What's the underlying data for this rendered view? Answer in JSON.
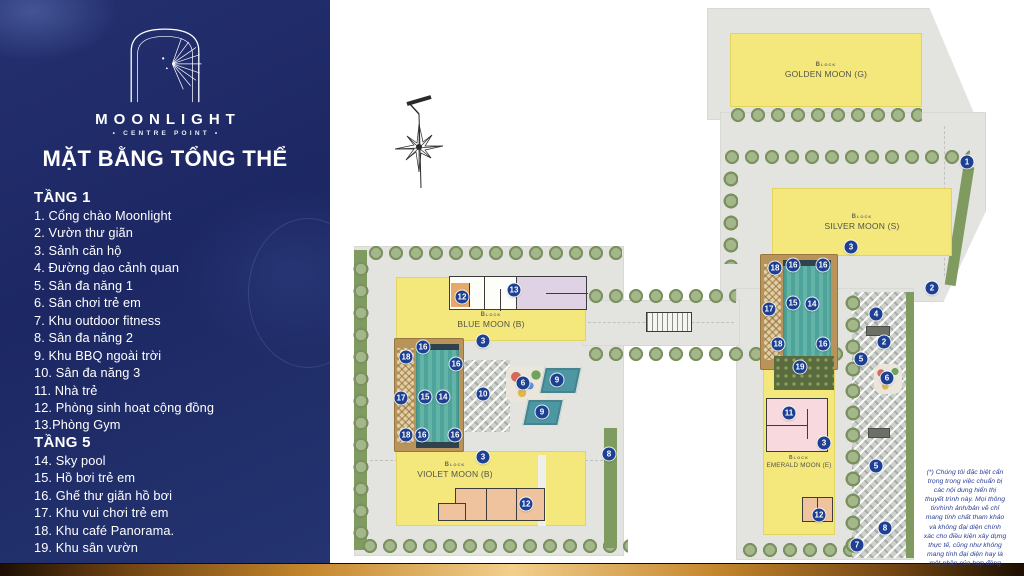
{
  "brand": {
    "name": "MOONLIGHT",
    "tagline": "• CENTRE POINT •"
  },
  "sidebar": {
    "title": "MẶT BẰNG TỔNG THỂ",
    "sections": [
      {
        "heading": "TẦNG 1",
        "items": [
          "1. Cổng chào Moonlight",
          "2. Vườn thư giãn",
          "3. Sảnh căn hộ",
          "4. Đường dạo cảnh quan",
          "5. Sân đa năng 1",
          "6. Sân chơi trẻ em",
          "7. Khu outdoor fitness",
          "8. Sân đa năng 2",
          "9. Khu BBQ ngoài trời",
          "10. Sân đa năng 3",
          "11. Nhà trẻ",
          "12. Phòng sinh hoạt cộng đồng",
          "13.Phòng Gym"
        ]
      },
      {
        "heading": "TẦNG 5",
        "items": [
          "14. Sky pool",
          "15. Hồ bơi trẻ em",
          "16. Ghế thư giãn hồ bơi",
          "17. Khu vui chơi trẻ em",
          "18. Khu café Panorama.",
          "19. Khu sân vườn"
        ]
      }
    ]
  },
  "map": {
    "blocks": [
      {
        "id": "golden",
        "block_label": "Block",
        "name": "GOLDEN MOON (G)"
      },
      {
        "id": "silver",
        "block_label": "Block",
        "name": "SILVER MOON (S)"
      },
      {
        "id": "blue",
        "block_label": "Block",
        "name": "BLUE MOON (B)"
      },
      {
        "id": "violet",
        "block_label": "Block",
        "name": "VIOLET MOON (B)"
      },
      {
        "id": "emerald",
        "block_label": "Block",
        "name": "EMERALD MOON (E)"
      }
    ],
    "markers": [
      {
        "n": "1",
        "x": 637,
        "y": 162
      },
      {
        "n": "3",
        "x": 521,
        "y": 247
      },
      {
        "n": "18",
        "x": 445,
        "y": 268
      },
      {
        "n": "16",
        "x": 463,
        "y": 265
      },
      {
        "n": "16",
        "x": 493,
        "y": 265
      },
      {
        "n": "17",
        "x": 439,
        "y": 309
      },
      {
        "n": "15",
        "x": 463,
        "y": 303
      },
      {
        "n": "14",
        "x": 482,
        "y": 304
      },
      {
        "n": "18",
        "x": 448,
        "y": 344
      },
      {
        "n": "16",
        "x": 493,
        "y": 344
      },
      {
        "n": "19",
        "x": 470,
        "y": 367
      },
      {
        "n": "2",
        "x": 602,
        "y": 288
      },
      {
        "n": "4",
        "x": 546,
        "y": 314
      },
      {
        "n": "2",
        "x": 554,
        "y": 342
      },
      {
        "n": "5",
        "x": 531,
        "y": 359
      },
      {
        "n": "6",
        "x": 557,
        "y": 378
      },
      {
        "n": "11",
        "x": 459,
        "y": 413
      },
      {
        "n": "3",
        "x": 494,
        "y": 443
      },
      {
        "n": "5",
        "x": 546,
        "y": 466
      },
      {
        "n": "12",
        "x": 489,
        "y": 515
      },
      {
        "n": "8",
        "x": 555,
        "y": 528
      },
      {
        "n": "7",
        "x": 527,
        "y": 545
      },
      {
        "n": "12",
        "x": 132,
        "y": 297
      },
      {
        "n": "13",
        "x": 184,
        "y": 290
      },
      {
        "n": "3",
        "x": 153,
        "y": 341
      },
      {
        "n": "16",
        "x": 93,
        "y": 347
      },
      {
        "n": "18",
        "x": 76,
        "y": 357
      },
      {
        "n": "16",
        "x": 126,
        "y": 364
      },
      {
        "n": "17",
        "x": 71,
        "y": 398
      },
      {
        "n": "15",
        "x": 95,
        "y": 397
      },
      {
        "n": "14",
        "x": 113,
        "y": 397
      },
      {
        "n": "10",
        "x": 153,
        "y": 394
      },
      {
        "n": "6",
        "x": 193,
        "y": 383
      },
      {
        "n": "9",
        "x": 227,
        "y": 380
      },
      {
        "n": "9",
        "x": 212,
        "y": 412
      },
      {
        "n": "18",
        "x": 76,
        "y": 435
      },
      {
        "n": "16",
        "x": 92,
        "y": 435
      },
      {
        "n": "16",
        "x": 125,
        "y": 435
      },
      {
        "n": "3",
        "x": 153,
        "y": 457
      },
      {
        "n": "8",
        "x": 279,
        "y": 454
      },
      {
        "n": "12",
        "x": 196,
        "y": 504
      }
    ],
    "disclaimer": "(*) Chúng tôi đặc biệt cẩn\ntrọng trong việc chuẩn bị\ncác nội dung hiển thị\nthuyết trình này. Mọi thông\ntin/hình ảnh/bản vẽ chỉ\nmang tính chất tham khảo\nvà không đại diện chính\nxác cho điều kiện xây dựng\nthực tế, cũng như không\nmang tính đại diện hay là\nmột phần của hợp đồng"
  },
  "colors": {
    "sidebar_navy": "#1f2b68",
    "block_yellow": "#f4e87c",
    "pool_teal": "#54a79e",
    "marker_blue": "#1e4093",
    "gold_bar": "#d79a3a",
    "plate_gray": "#e3e3e0",
    "landscape_green": "#7f9b60"
  }
}
